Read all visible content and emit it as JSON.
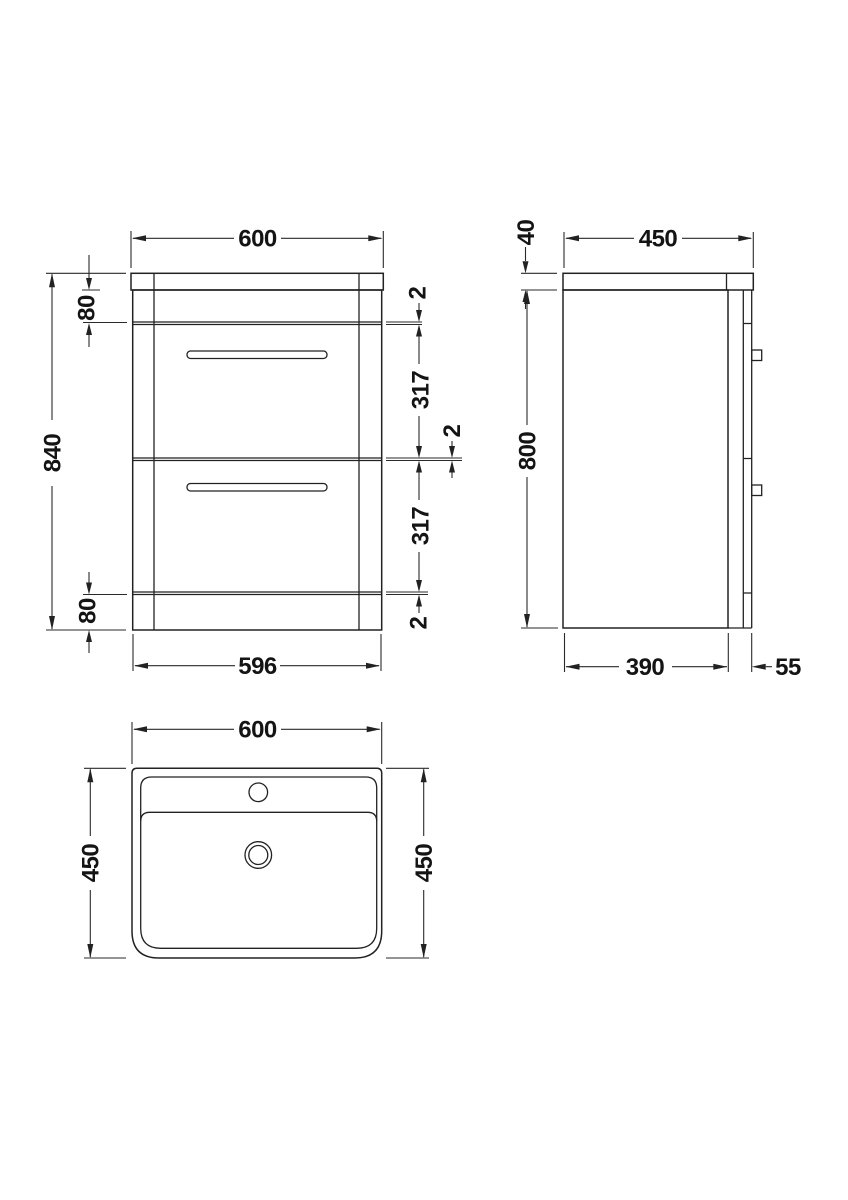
{
  "drawing": {
    "background": "#ffffff",
    "line_color": "#222222",
    "front": {
      "width_top": "600",
      "overall_height": "840",
      "top_section": "80",
      "gap_top": "2",
      "drawer1_height": "317",
      "gap_middle": "2",
      "drawer2_height": "317",
      "gap_bottom": "2",
      "bottom_section": "80",
      "width_bottom": "596"
    },
    "side": {
      "worktop_thickness": "40",
      "overall_depth": "450",
      "body_height": "800",
      "body_depth": "390",
      "drawer_front_depth": "55"
    },
    "basin": {
      "width": "600",
      "depth_left": "450",
      "depth_right": "450"
    }
  }
}
